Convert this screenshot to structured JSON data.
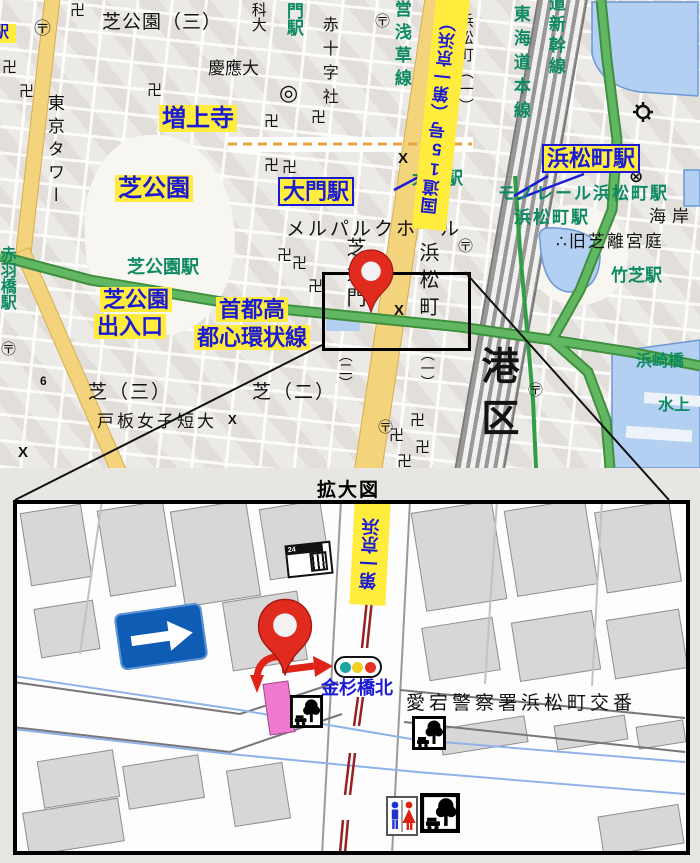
{
  "colors": {
    "highlight_yellow": "#ffec3d",
    "label_blue": "#1b1bd6",
    "station_green": "#0e8a63",
    "road_yellow": "#f3d37b",
    "road_edge": "#d9ae52",
    "expwy": "#62b862",
    "expwy_dark": "#3f8f3f",
    "water": "#b3cff1",
    "water_edge": "#6b98d4",
    "pin_red": "#e22b1f",
    "rail_maroon": "#992020",
    "sign_blue": "#0f5cb5",
    "building_pink": "#f07ad0",
    "bld_gray": "#d7d7d7"
  },
  "overview": {
    "labels": {
      "shiba_koen_3": "芝公園（三）",
      "zojoji": "増上寺",
      "tokyo_tower": "東京タワー",
      "shiba_koen": "芝公園",
      "shiba_koen_sta": "芝公園駅",
      "akabanebashi_sta": "赤羽橋駅",
      "daimon_sta_hl": "大門駅",
      "daimon_sta_map": "大門駅",
      "hamamatsucho_sta_hl": "浜松町駅",
      "monorail_hamamatsucho_sta": "モノレール浜松町駅",
      "hamamatsucho_sta_map": "浜松町駅",
      "keio_univ": "慶應大",
      "kadai": "科大",
      "gate_sta": "門駅",
      "red_cross": "赤十字社",
      "asakusa_line": "営浅草線",
      "route15": "国道15号（第一京浜）",
      "hamamatsucho_1_v": "浜松町（一）",
      "tokaido_main": "東海道本線",
      "shinkansen": "道新幹線",
      "kaigan": "海岸",
      "kyu_shiba_rikyu": "∴旧芝離宮庭",
      "takeshiba_sta": "竹芝駅",
      "mielparque": "メルパルクホール",
      "hamamatsucho_v": "浜松町",
      "ichi": "（一）",
      "shibadaimon_v": "芝大門",
      "ni": "（二）",
      "shiba_exit_1": "芝公園",
      "shiba_exit_2": "出入口",
      "shuto_1": "首都高",
      "shuto_2": "都心環状線",
      "shiba_3": "芝（三）",
      "toita": "戸板女子短大",
      "shiba_2": "芝（二）",
      "minato_ku": "港区",
      "hamazakibashi": "浜崎橋",
      "suijo": "水上",
      "edge_partial": "駅",
      "route6": "6"
    }
  },
  "symbols": {
    "manji": "卍",
    "post": "〶",
    "univ": "◎",
    "police_x": "X",
    "police_circle": "⊗"
  },
  "enlarged": {
    "title": "拡大図",
    "route_label": "第一京浜",
    "kanasugibashi_kita": "金杉橋北",
    "koban": "愛宕警察署浜松町交番",
    "store_24": "24"
  }
}
